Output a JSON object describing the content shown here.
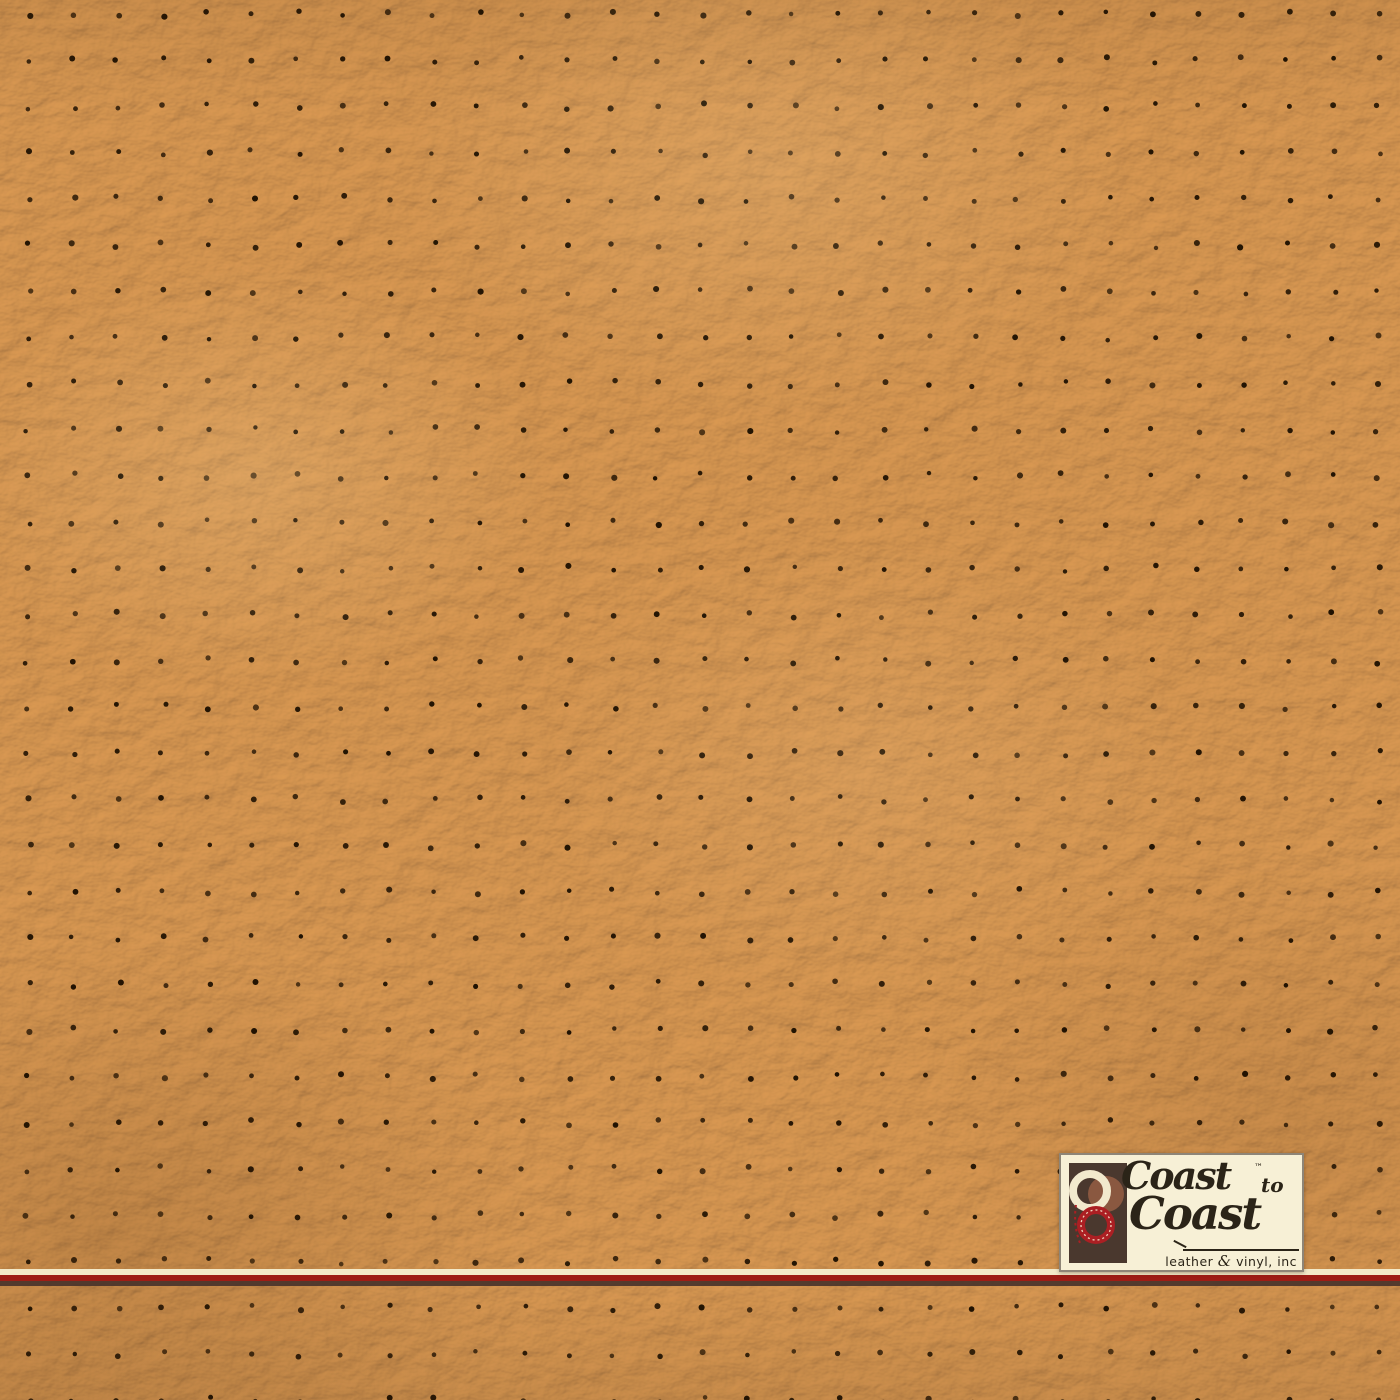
{
  "image": {
    "subject": "perforated-leather-swatch",
    "material": "tan pebble-grain leather with perforation holes",
    "colors": {
      "leather_average": "#b57c42",
      "leather_tint": "#d89e58",
      "leather_highlight": "#cf9a5e",
      "leather_shadow": "#8a5a2c",
      "perforation_dot": "#201202"
    },
    "perforation_grid": {
      "rows": 31,
      "cols": 32,
      "offset_x": 28,
      "offset_y": 14,
      "spacing_x": 45,
      "spacing_y": 46.2,
      "dot_radius": 2.2,
      "jitter": 3
    }
  },
  "divider": {
    "cream": "#f3e9c8",
    "red": "#9e1c15",
    "brown": "#46312a"
  },
  "logo": {
    "word1": "Coast",
    "trademark": "™",
    "word2": "to",
    "word3": "Coast",
    "tagline_leather": "leather",
    "tagline_amp": "&",
    "tagline_vinyl": "vinyl, inc",
    "colors": {
      "background": "#f7f0d6",
      "border": "#8e8577",
      "text": "#2b2418",
      "icon_background": "#4a382e",
      "icon_cream_ring": "#f2e9cd",
      "icon_brown_circle": "#8a5840",
      "icon_red_ring": "#ab1f23"
    }
  }
}
